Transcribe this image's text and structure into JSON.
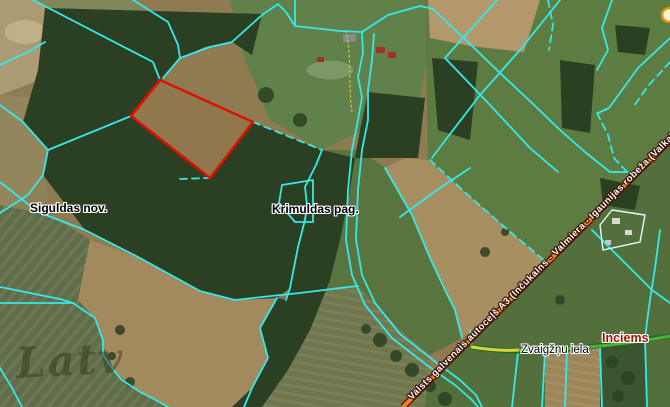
{
  "map": {
    "region_labels": {
      "municipality": "Siguldas nov.",
      "parish": "Krimuldas pag."
    },
    "place_labels": {
      "village": "Inciems",
      "street": "Zvaigžņu iela",
      "highway": "Valsts galvenais autoceļš A3 (Inčukalns - Valmiera - Igaunijas robeža (Valka)"
    },
    "watermark": "Latv",
    "colors": {
      "parcel_boundary": "#35e9e9",
      "selected_parcel": "#e01000",
      "highway_fill": "#f5821e",
      "highway_casing": "#5d1f10",
      "street_fill": "#4caf3f",
      "village_label": "#991500",
      "highway_label": "#ffffff"
    }
  }
}
